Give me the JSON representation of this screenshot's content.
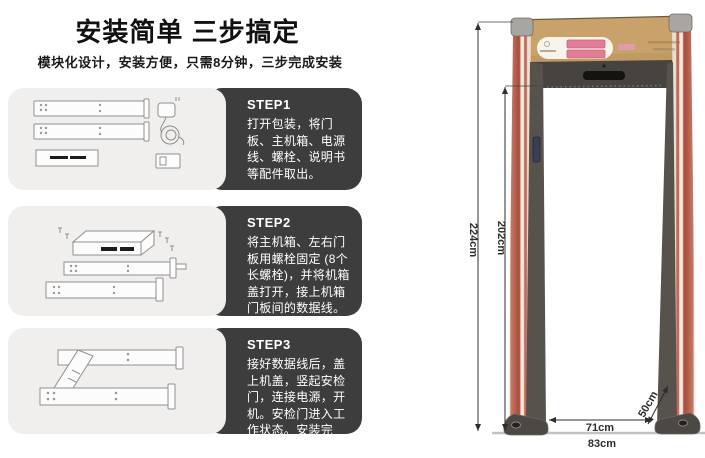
{
  "header": {
    "title": "安装简单 三步搞定",
    "subtitle": "模块化设计，安装方便，只需8分钟，三步完成安装"
  },
  "steps": [
    {
      "label": "STEP1",
      "text": "打开包装，将门板、主机箱、电源线、螺栓、说明书等配件取出。",
      "illustration": "door-panels-power-adapter-manual"
    },
    {
      "label": "STEP2",
      "text": "将主机箱、左右门板用螺栓固定 (8个长螺栓)，并将机箱盖打开，接上机箱门板间的数据线。",
      "illustration": "main-unit-bolts-door-panels"
    },
    {
      "label": "STEP3",
      "text": "接好数据线后，盖上机盖，竖起安检门，连接电源，开机。安检门进入工作状态。安装完成。",
      "illustration": "assembled-detector-frame"
    }
  ],
  "diagram": {
    "type": "walk-through-metal-detector",
    "dimensions": {
      "outer_height": "224cm",
      "inner_height": "202cm",
      "inner_width": "71cm",
      "outer_width": "83cm",
      "base_depth": "50cm"
    },
    "colors": {
      "crossbar_gold": "#c9a26b",
      "control_panel": "#f8f4ec",
      "led_display": "#e27e94",
      "column_stripe_red": "#a94e3f",
      "column_side_grey": "#57524c",
      "callout_dark": "#3e3d3d",
      "panel_grey": "#f0efee"
    }
  }
}
